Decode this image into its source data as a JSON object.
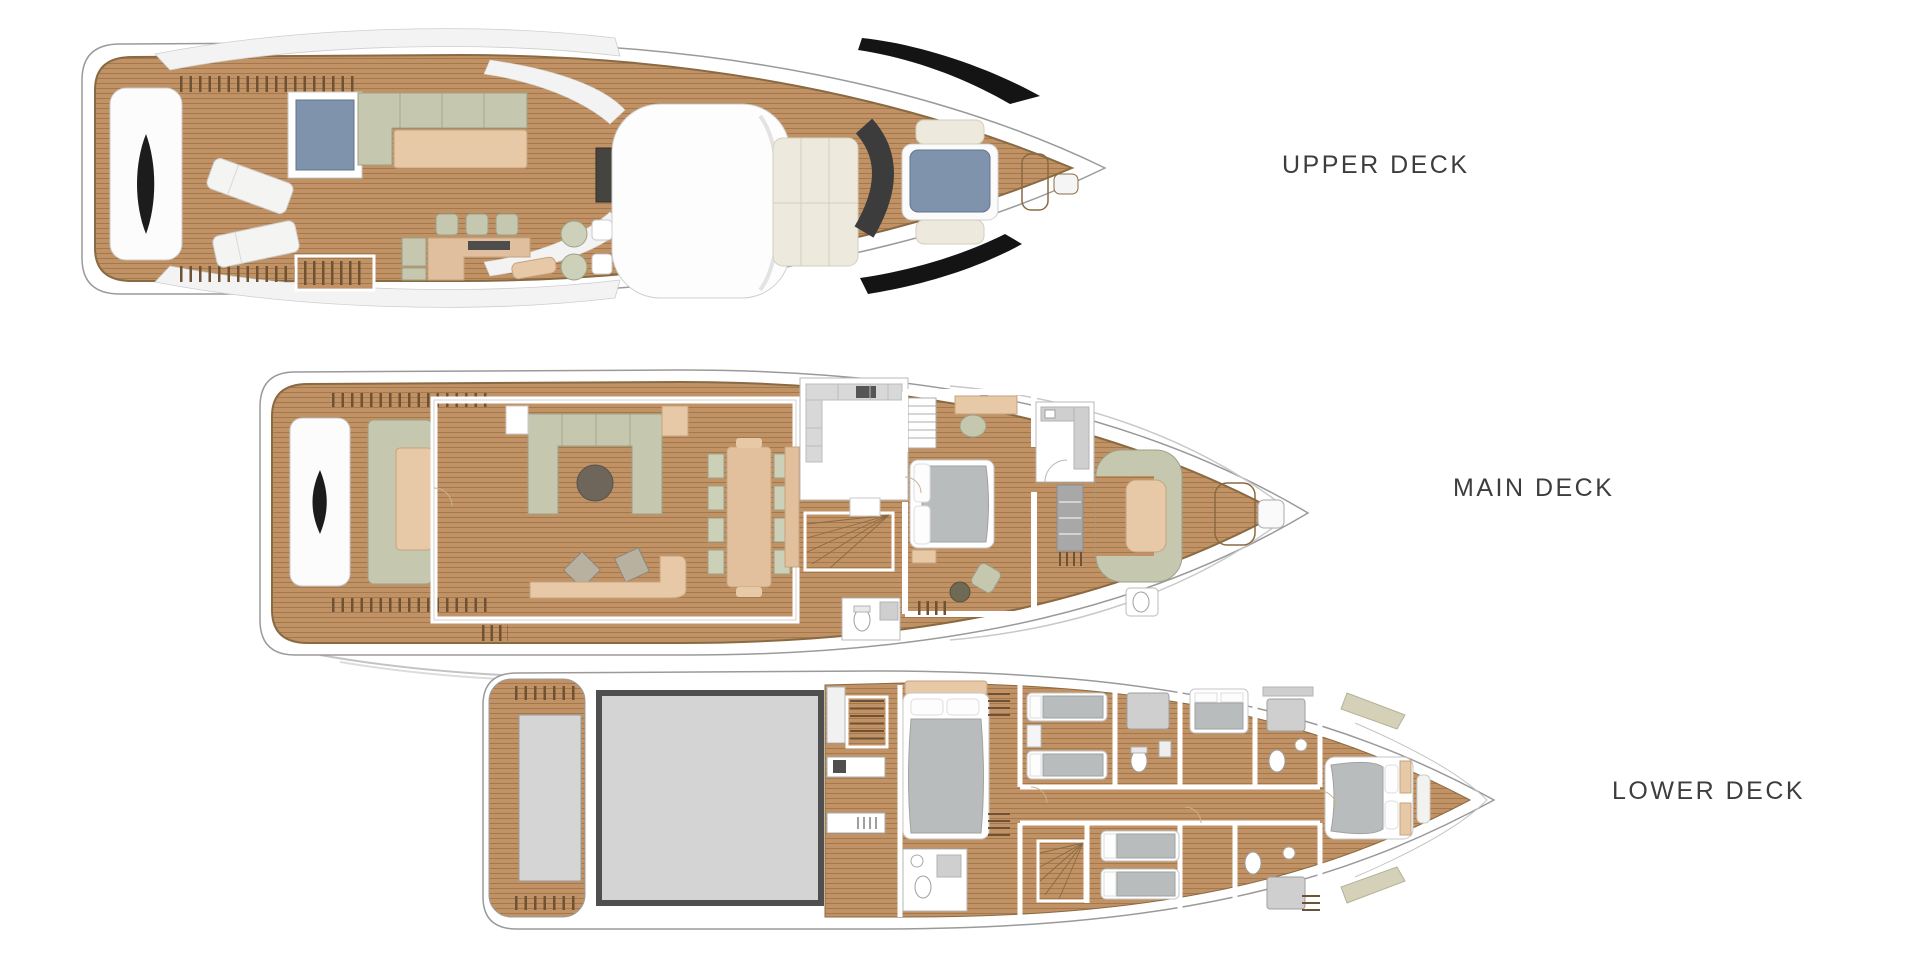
{
  "title": "Yacht deck plans",
  "palette": {
    "paper": "#ffffff",
    "label": "#3d3d3d",
    "hullFill": "#ffffff",
    "hullStroke": "#9a9a9a",
    "wood": "#c09265",
    "woodLine": "#a3794b",
    "woodEdge": "#8a6a42",
    "sofa": "#c5c8ae",
    "sofaStroke": "#9da188",
    "pad": "#e7c9a7",
    "padStroke": "#c5a47e",
    "cream": "#edeadd",
    "creamStroke": "#d2cfbe",
    "spa": "#8093ad",
    "spaStroke": "#62748f",
    "bed": "#b9bcbd",
    "bedStroke": "#9fa2a3",
    "dark": "#3f3f3f",
    "engine": "#d4d4d4",
    "engineStroke": "#4f4f4f",
    "tile": "#cfcfcf",
    "comb": "#6e5233"
  },
  "decks": [
    {
      "id": "upper",
      "label": "UPPER DECK",
      "items": [
        "aft-platform",
        "railings",
        "spa-pool",
        "l-shaped-sofa",
        "sunpad",
        "sun-loungers",
        "deck-stairs",
        "wet-bar",
        "bar-stools",
        "fridge-units",
        "round-chairs",
        "side-tables",
        "grill-console",
        "hardtop",
        "foredeck-sunpads",
        "windshield",
        "bow-sunpad",
        "bow-seat-pads",
        "deck-hatches"
      ]
    },
    {
      "id": "main",
      "label": "MAIN DECK",
      "items": [
        "aft-platform",
        "aft-sofa",
        "railings",
        "salon-u-sofa",
        "coffee-table",
        "ottomans",
        "chaise-lounge",
        "side-table",
        "cabinet",
        "dining-table",
        "dining-chairs",
        "sideboard",
        "galley",
        "pantry-shelves",
        "staircase",
        "master-bed",
        "vanity-desk",
        "vanity-chair",
        "armchair",
        "side-lamp-table",
        "day-head",
        "locker",
        "powder-room",
        "helm-settee",
        "helm-table",
        "bow-hatches",
        "bow-console"
      ]
    },
    {
      "id": "lower",
      "label": "LOWER DECK",
      "items": [
        "swim-platform",
        "tender-hatch",
        "engine-room",
        "crew-bunk",
        "crew-stairs",
        "crew-galley",
        "aft-cabin-bed",
        "wardrobes",
        "ensuite-bathroom",
        "twin-cabin-beds",
        "guest-bathrooms",
        "corridor",
        "staircase",
        "vip-bed",
        "vip-wardrobes"
      ]
    }
  ]
}
